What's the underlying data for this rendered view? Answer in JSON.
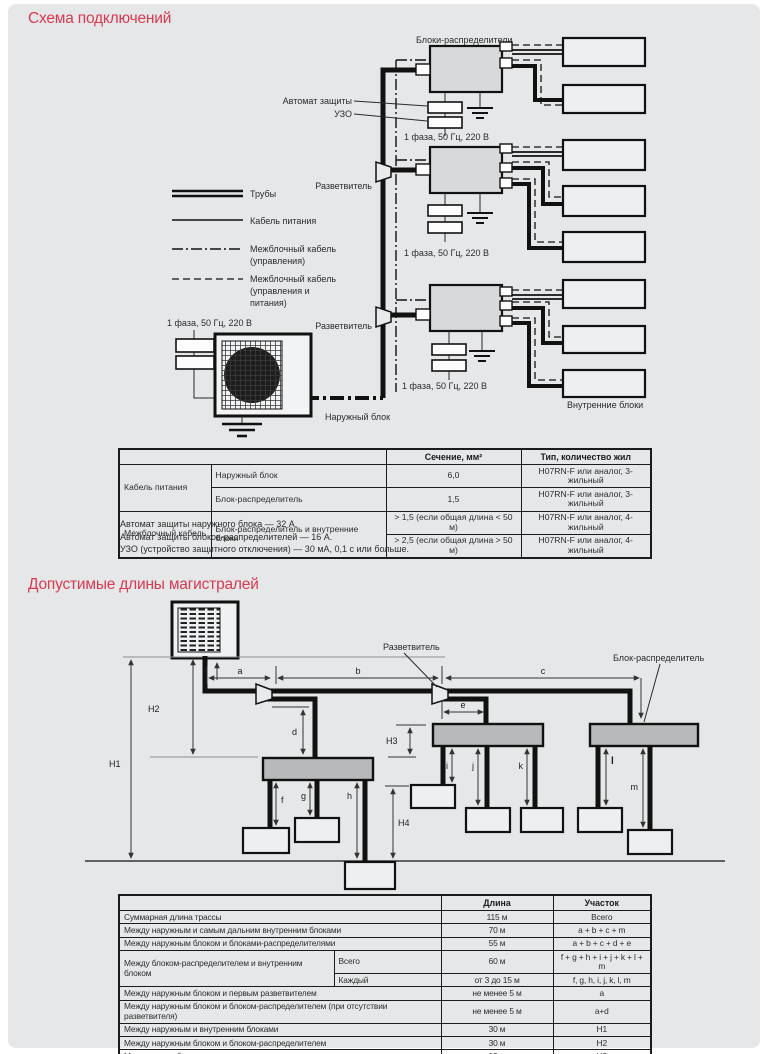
{
  "section1": {
    "title": "Схема подключений"
  },
  "section2": {
    "title": "Допустимые длины магистралей"
  },
  "diagram1": {
    "top_label": "Блоки-распределители",
    "breaker_label": "Автомат защиты",
    "rcd_label": "УЗО",
    "phase_label": "1 фаза, 50 Гц, 220 В",
    "splitter_label": "Разветвитель",
    "outdoor_label": "Наружный блок",
    "indoor_label": "Внутренние блоки",
    "legend": {
      "pipes": "Трубы",
      "power": "Кабель питания",
      "control_1": "Межблочный кабель",
      "control_2": "(управления)",
      "cp_1": "Межблочный кабель",
      "cp_2": "(управления и",
      "cp_3": "питания)"
    }
  },
  "cable_table": {
    "col_section": "Сечение, мм²",
    "col_type": "Тип, количество жил",
    "group1": "Кабель питания",
    "group2": "Межблочный кабель",
    "r1_item": "Наружный блок",
    "r1_section": "6,0",
    "r1_type": "H07RN-F или аналог, 3-жильный",
    "r2_item": "Блок-распределитель",
    "r2_section": "1,5",
    "r2_type": "H07RN-F или аналог, 3-жильный",
    "r3_item": "Блок-распределитель и внутренние блоки",
    "r3_section": "> 1,5 (если общая длина < 50 м)",
    "r3_type": "H07RN-F или аналог, 4-жильный",
    "r4_section": "> 2,5 (если общая длина > 50 м)",
    "r4_type": "H07RN-F или аналог, 4-жильный"
  },
  "notes": {
    "n1": "Автомат защиты наружного блока — 32 А.",
    "n2": "Автомат защиты блоков-распределителей — 16 А.",
    "n3": "УЗО (устройство защитного отключения) — 30 мА, 0,1 с или больше."
  },
  "diagram2": {
    "splitter_label": "Разветвитель",
    "distributor_label": "Блок-распределитель",
    "dims": {
      "a": "a",
      "b": "b",
      "c": "c",
      "d": "d",
      "e": "e",
      "f": "f",
      "g": "g",
      "h": "h",
      "i": "i",
      "j": "j",
      "k": "k",
      "l": "l",
      "m": "m",
      "H1": "H1",
      "H2": "H2",
      "H3": "H3",
      "H4": "H4"
    }
  },
  "length_table": {
    "col_length": "Длина",
    "col_segment": "Участок",
    "rows": [
      {
        "name": "Суммарная длина трассы",
        "length": "115 м",
        "segment": "Всего"
      },
      {
        "name": "Между наружным и самым дальним внутренним блоками",
        "length": "70 м",
        "segment": "a + b + c + m"
      },
      {
        "name": "Между наружным блоком и блоками-распределителями",
        "length": "55 м",
        "segment": "a + b + c + d + e"
      },
      {
        "name": "Между блоком-распределителем и внутренним блоком",
        "sub": "Всего",
        "length": "60 м",
        "segment": "f + g + h + i + j + k + l + m"
      },
      {
        "sub": "Каждый",
        "length": "от 3 до 15 м",
        "segment": "f, g, h, i, j, k, l, m"
      },
      {
        "name": "Между наружным блоком и первым разветвителем",
        "length": "не менее 5 м",
        "segment": "a"
      },
      {
        "name": "Между наружным блоком и блоком-распределителем (при отсутствии разветвителя)",
        "length": "не менее 5 м",
        "segment": "a+d"
      },
      {
        "name": "Между наружным и внутренним блоками",
        "length": "30 м",
        "segment": "H1"
      },
      {
        "name": "Между наружным блоком и блоком-распределителем",
        "length": "30 м",
        "segment": "H2"
      },
      {
        "name": "Между двумя блоками-распределителями",
        "length": "15 м",
        "segment": "H3"
      },
      {
        "name": "Между внутренними блоками",
        "length": "15 м",
        "segment": "H4"
      }
    ]
  }
}
